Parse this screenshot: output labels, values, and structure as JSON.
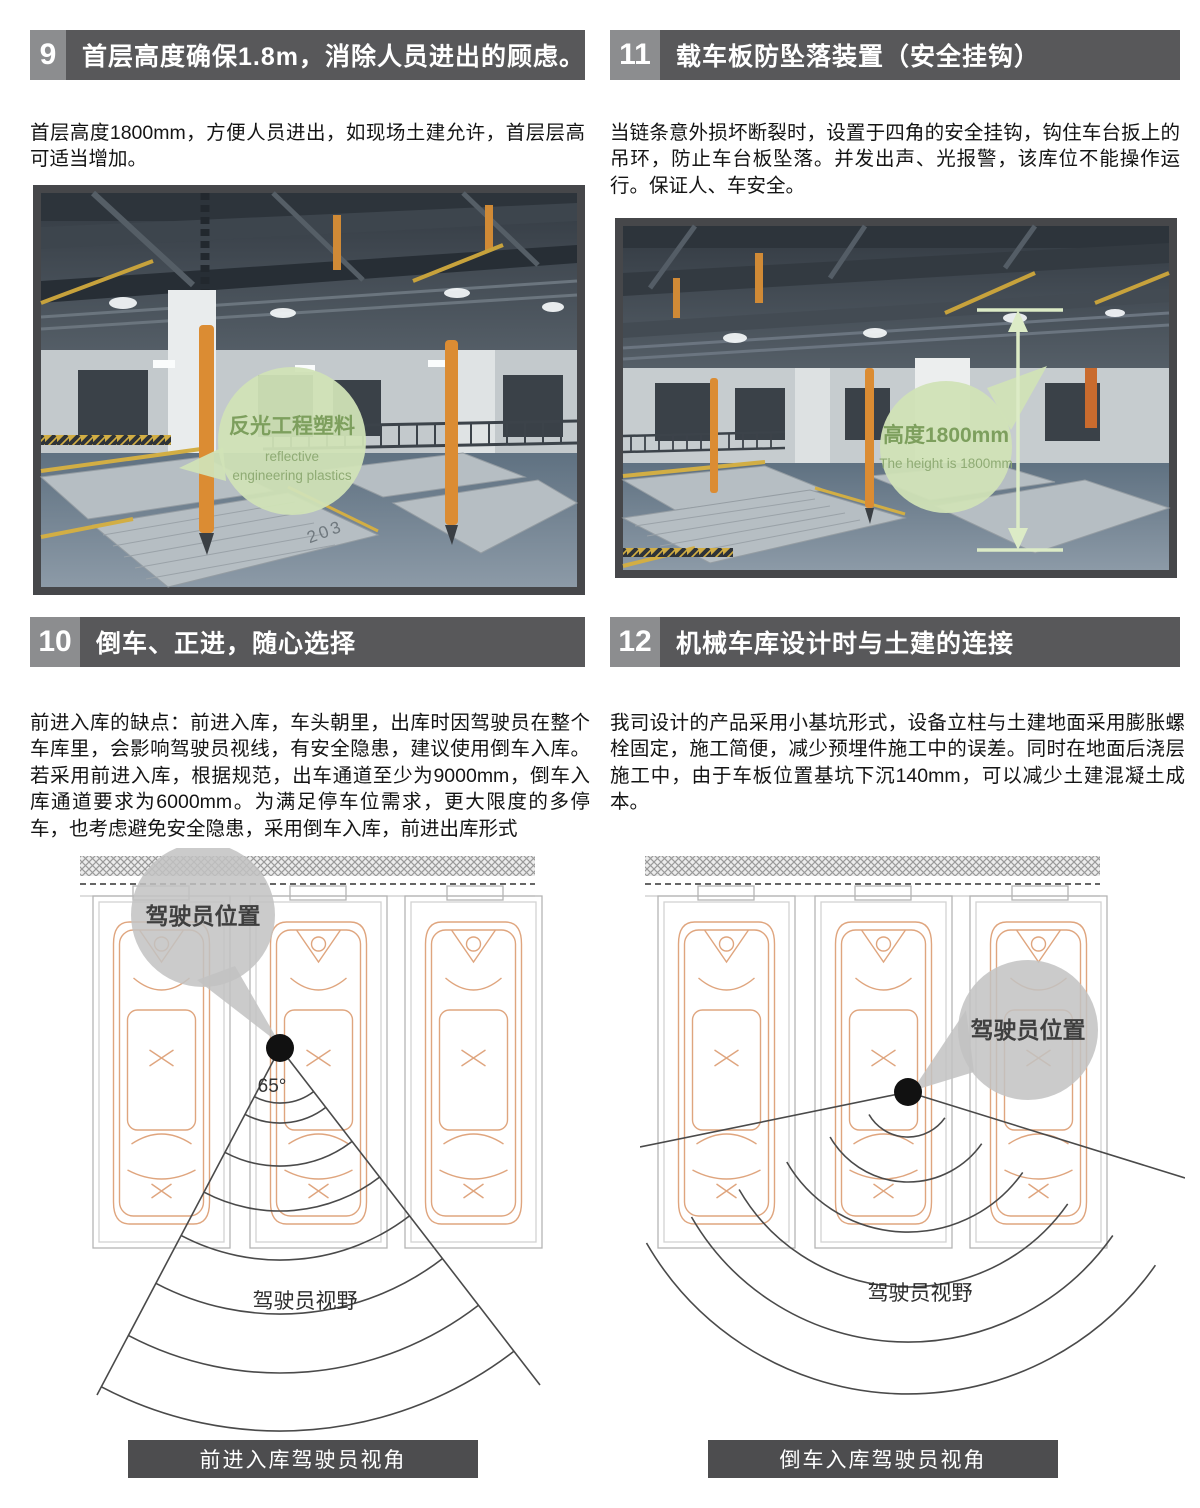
{
  "sections": {
    "s9": {
      "number": "9",
      "title": "首层高度确保1.8m，消除人员进出的顾虑。",
      "body": "首层高度1800mm，方便人员进出，如现场土建允许，首层层高可适当增加。",
      "photo": {
        "callout_zh": "反光工程塑料",
        "callout_en_line1": "reflective",
        "callout_en_line2": "engineering plastics",
        "stall_number": "203"
      }
    },
    "s11": {
      "number": "11",
      "title": "载车板防坠落装置（安全挂钩）",
      "body": "当链条意外损坏断裂时，设置于四角的安全挂钩，钩住车台扳上的吊环，防止车台板坠落。并发出声、光报警，该库位不能操作运行。保证人、车安全。",
      "photo": {
        "callout_zh": "高度1800mm",
        "callout_en": "The height is 1800mm"
      }
    },
    "s10": {
      "number": "10",
      "title": "倒车、正进，随心选择",
      "body": "前进入库的缺点：前进入库，车头朝里，出库时因驾驶员在整个车库里，会影响驾驶员视线，有安全隐患，建议使用倒车入库。若采用前进入库，根据规范，出车通道至少为9000mm，倒车入库通道要求为6000mm。为满足停车位需求，更大限度的多停车，也考虑避免安全隐患，采用倒车入库，前进出库形式",
      "diagram": {
        "driver_position_label": "驾驶员位置",
        "angle_label": "65°",
        "view_label": "驾驶员视野",
        "caption": "前进入库驾驶员视角"
      }
    },
    "s12": {
      "number": "12",
      "title": "机械车库设计时与土建的连接",
      "body": "我司设计的产品采用小基坑形式，设备立柱与土建地面采用膨胀螺栓固定，施工简便，减少预埋件施工中的误差。同时在地面后浇层施工中，由于车板位置基坑下沉140mm，可以减少土建混凝土成本。",
      "diagram": {
        "driver_position_label": "驾驶员位置",
        "view_label": "驾驶员视野",
        "caption": "倒车入库驾驶员视角"
      }
    }
  },
  "colors": {
    "header_bar": "#58585a",
    "header_number_box": "#8c8d8f",
    "caption_bar": "#4d4d4f",
    "body_text": "#141414",
    "photo_frame": "#46474a",
    "callout_green_bg": "#d0e2b7",
    "callout_green_text": "#7d9f5d",
    "callout_gray_bg": "#c2c2c2",
    "diagram_line": "#4a4a4a",
    "car_outline_orange": "#dfa57e",
    "measure_arrow_green": "#dcebc6",
    "floor_blue_gray": "#6b7c8d",
    "post_orange": "#db8c33"
  }
}
